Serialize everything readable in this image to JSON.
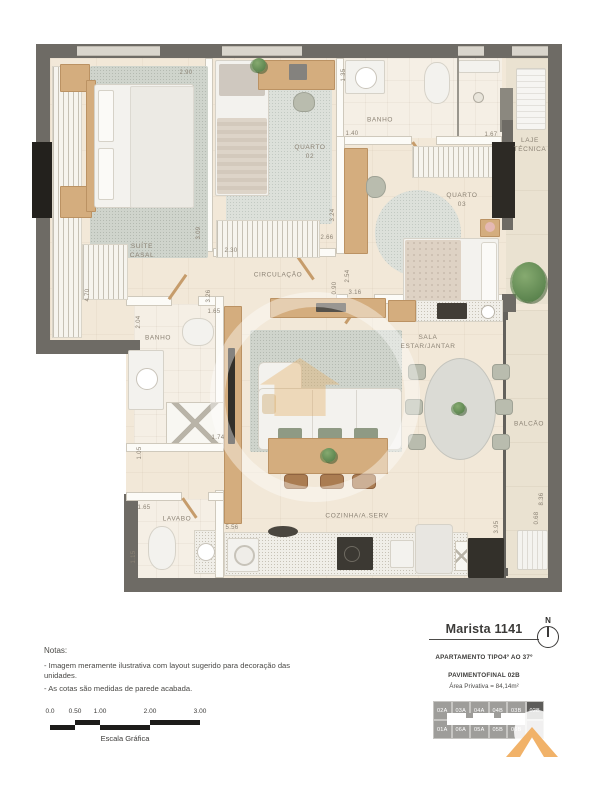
{
  "plan": {
    "rooms": [
      {
        "t": "SUÍTE CASAL",
        "x": 142,
        "y": 252
      },
      {
        "t": "QUARTO 02",
        "x": 310,
        "y": 153
      },
      {
        "t": "BANHO",
        "x": 380,
        "y": 121
      },
      {
        "t": "QUARTO 03",
        "x": 462,
        "y": 201
      },
      {
        "t": "LAJE\nTÉCNICA",
        "x": 530,
        "y": 146
      },
      {
        "t": "CIRCULAÇÃO",
        "x": 278,
        "y": 276
      },
      {
        "t": "BANHO",
        "x": 158,
        "y": 339
      },
      {
        "t": "SALA ESTAR/JANTAR",
        "x": 428,
        "y": 343
      },
      {
        "t": "BALCÃO",
        "x": 529,
        "y": 425
      },
      {
        "t": "LAVABO",
        "x": 177,
        "y": 520
      },
      {
        "t": "COZINHA/A.SERV",
        "x": 357,
        "y": 517
      }
    ],
    "cotas": [
      {
        "t": "2.90",
        "x": 186,
        "y": 73
      },
      {
        "t": "1.35",
        "x": 344,
        "y": 75,
        "rot": true
      },
      {
        "t": "1.40",
        "x": 352,
        "y": 134
      },
      {
        "t": "1.67",
        "x": 491,
        "y": 135
      },
      {
        "t": "3.09",
        "x": 199,
        "y": 233,
        "rot": true
      },
      {
        "t": "2.30",
        "x": 231,
        "y": 251
      },
      {
        "t": "3.24",
        "x": 333,
        "y": 215,
        "rot": true
      },
      {
        "t": "2.66",
        "x": 327,
        "y": 238
      },
      {
        "t": "2.54",
        "x": 348,
        "y": 276,
        "rot": true
      },
      {
        "t": "0.90",
        "x": 335,
        "y": 288,
        "rot": true
      },
      {
        "t": "3.16",
        "x": 355,
        "y": 293
      },
      {
        "t": "3.26",
        "x": 209,
        "y": 296,
        "rot": true
      },
      {
        "t": "1.65",
        "x": 214,
        "y": 312
      },
      {
        "t": "2.04",
        "x": 139,
        "y": 322,
        "rot": true
      },
      {
        "t": "4.70",
        "x": 88,
        "y": 295,
        "rot": true
      },
      {
        "t": "1.74",
        "x": 218,
        "y": 438
      },
      {
        "t": "1.05",
        "x": 140,
        "y": 453,
        "rot": true
      },
      {
        "t": "1.65",
        "x": 144,
        "y": 508
      },
      {
        "t": "1.15",
        "x": 134,
        "y": 557,
        "rot": true
      },
      {
        "t": "5.56",
        "x": 232,
        "y": 528
      },
      {
        "t": "8.36",
        "x": 542,
        "y": 499,
        "rot": true
      },
      {
        "t": "0.68",
        "x": 537,
        "y": 518,
        "rot": true
      },
      {
        "t": "3.95",
        "x": 497,
        "y": 527,
        "rot": true
      }
    ]
  },
  "title_block": {
    "project": "Marista 1141",
    "lines": [
      "APARTAMENTO TIPO",
      "4º AO 37º PAVIMENTO",
      "FINAL 02B"
    ],
    "area_line": "Área Privativa = 84,14m²",
    "compass_label": "N"
  },
  "key_plan": {
    "highlighted": "02B",
    "top_row": [
      "02A",
      "03A",
      "04A",
      "04B",
      "03B",
      {
        "t": "02B",
        "cls": "hl"
      }
    ],
    "bottom_row": [
      "01A",
      "06A",
      "05A",
      "05B",
      "06B",
      ""
    ]
  },
  "notes": {
    "heading": "Notas:",
    "items": [
      "- Imagem meramente ilustrativa com layout sugerido para decoração das unidades.",
      "- As cotas são medidas de parede acabada."
    ]
  },
  "scale_bar": {
    "ticks": [
      {
        "t": "0.0",
        "x": 50
      },
      {
        "t": "0.50",
        "x": 75
      },
      {
        "t": "1.00",
        "x": 100
      },
      {
        "t": "2.00",
        "x": 150
      },
      {
        "t": "3.00",
        "x": 200
      }
    ],
    "caption": "Escala Gráfica"
  },
  "colors": {
    "wall": "#6e6b65",
    "floor": "#f2e8d8",
    "wood": "#d4ad7e",
    "accent_logo": "#f1b269",
    "keyplan_cell": "#9e9d9a",
    "keyplan_highlight": "#5d5c5a",
    "label_text": "#8b8274"
  }
}
